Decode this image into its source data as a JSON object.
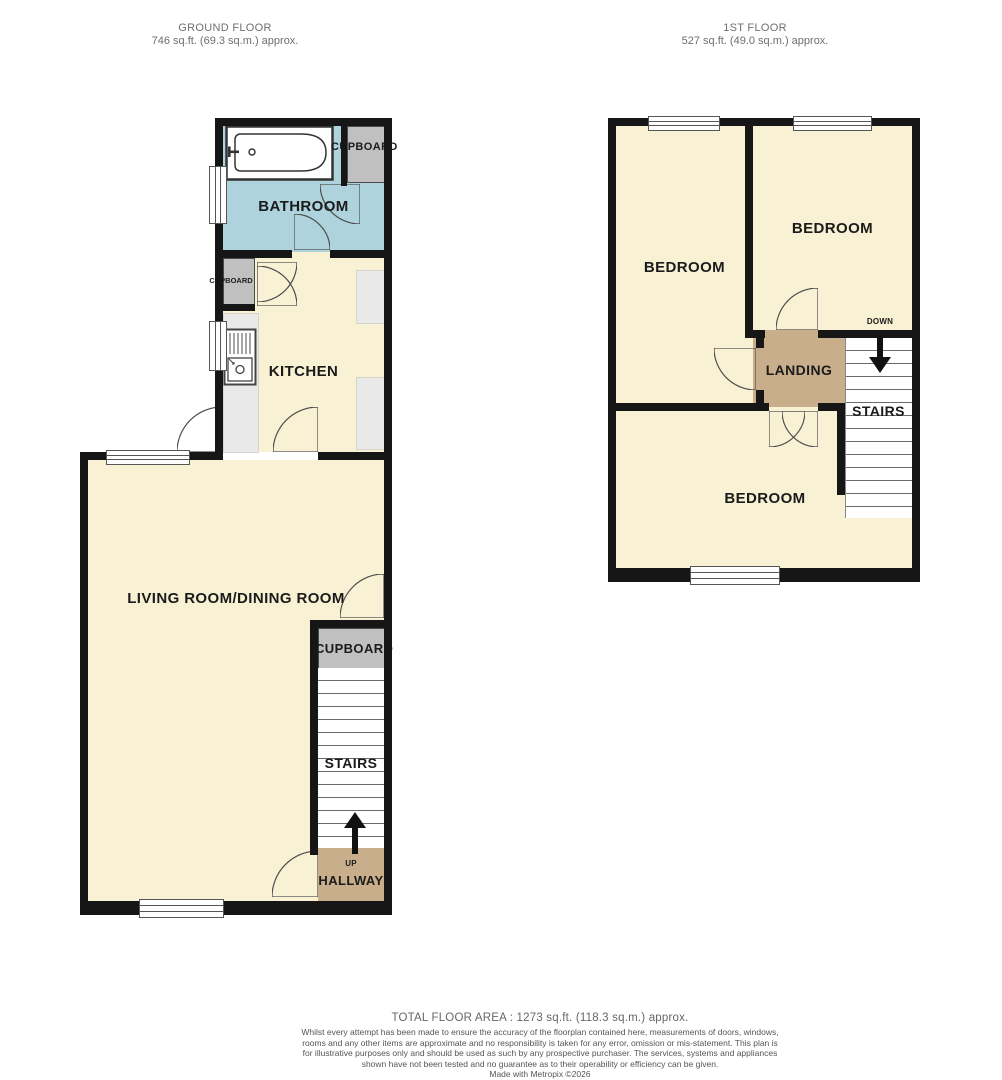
{
  "ground_floor": {
    "header": {
      "title": "GROUND FLOOR",
      "area": "746 sq.ft. (69.3 sq.m.) approx."
    },
    "labels": {
      "bathroom": "BATHROOM",
      "bathroom_cupboard": "CUPBOARD",
      "kitchen": "KITCHEN",
      "kitchen_cupboard": "CUPBOARD",
      "living_room": "LIVING ROOM/DINING ROOM",
      "stairs_cupboard": "CUPBOARD",
      "stairs": "STAIRS",
      "up": "UP",
      "hallway": "HALLWAY"
    }
  },
  "first_floor": {
    "header": {
      "title": "1ST FLOOR",
      "area": "527 sq.ft. (49.0 sq.m.) approx."
    },
    "labels": {
      "bedroom_left": "BEDROOM",
      "bedroom_right": "BEDROOM",
      "bedroom_bottom": "BEDROOM",
      "landing": "LANDING",
      "stairs": "STAIRS",
      "down": "DOWN"
    }
  },
  "footer": {
    "total_area": "TOTAL FLOOR AREA : 1273 sq.ft. (118.3 sq.m.) approx.",
    "disclaimer": "Whilst every attempt has been made to ensure the accuracy of the floorplan contained here, measurements of doors, windows, rooms and any other items are approximate and no responsibility is taken for any error, omission or mis-statement. This plan is for illustrative purposes only and should be used as such by any prospective purchaser. The services, systems and appliances shown have not been tested and no guarantee as to their operability or efficiency can be given.",
    "credit": "Made with Metropix ©2026"
  },
  "colors": {
    "wall": "#161616",
    "room": "#F8F1D3",
    "bathroom": "#AED3DC",
    "hall": "#C9AE8C",
    "cupboard": "#C0C0C0",
    "counter": "#E9E9E9"
  }
}
